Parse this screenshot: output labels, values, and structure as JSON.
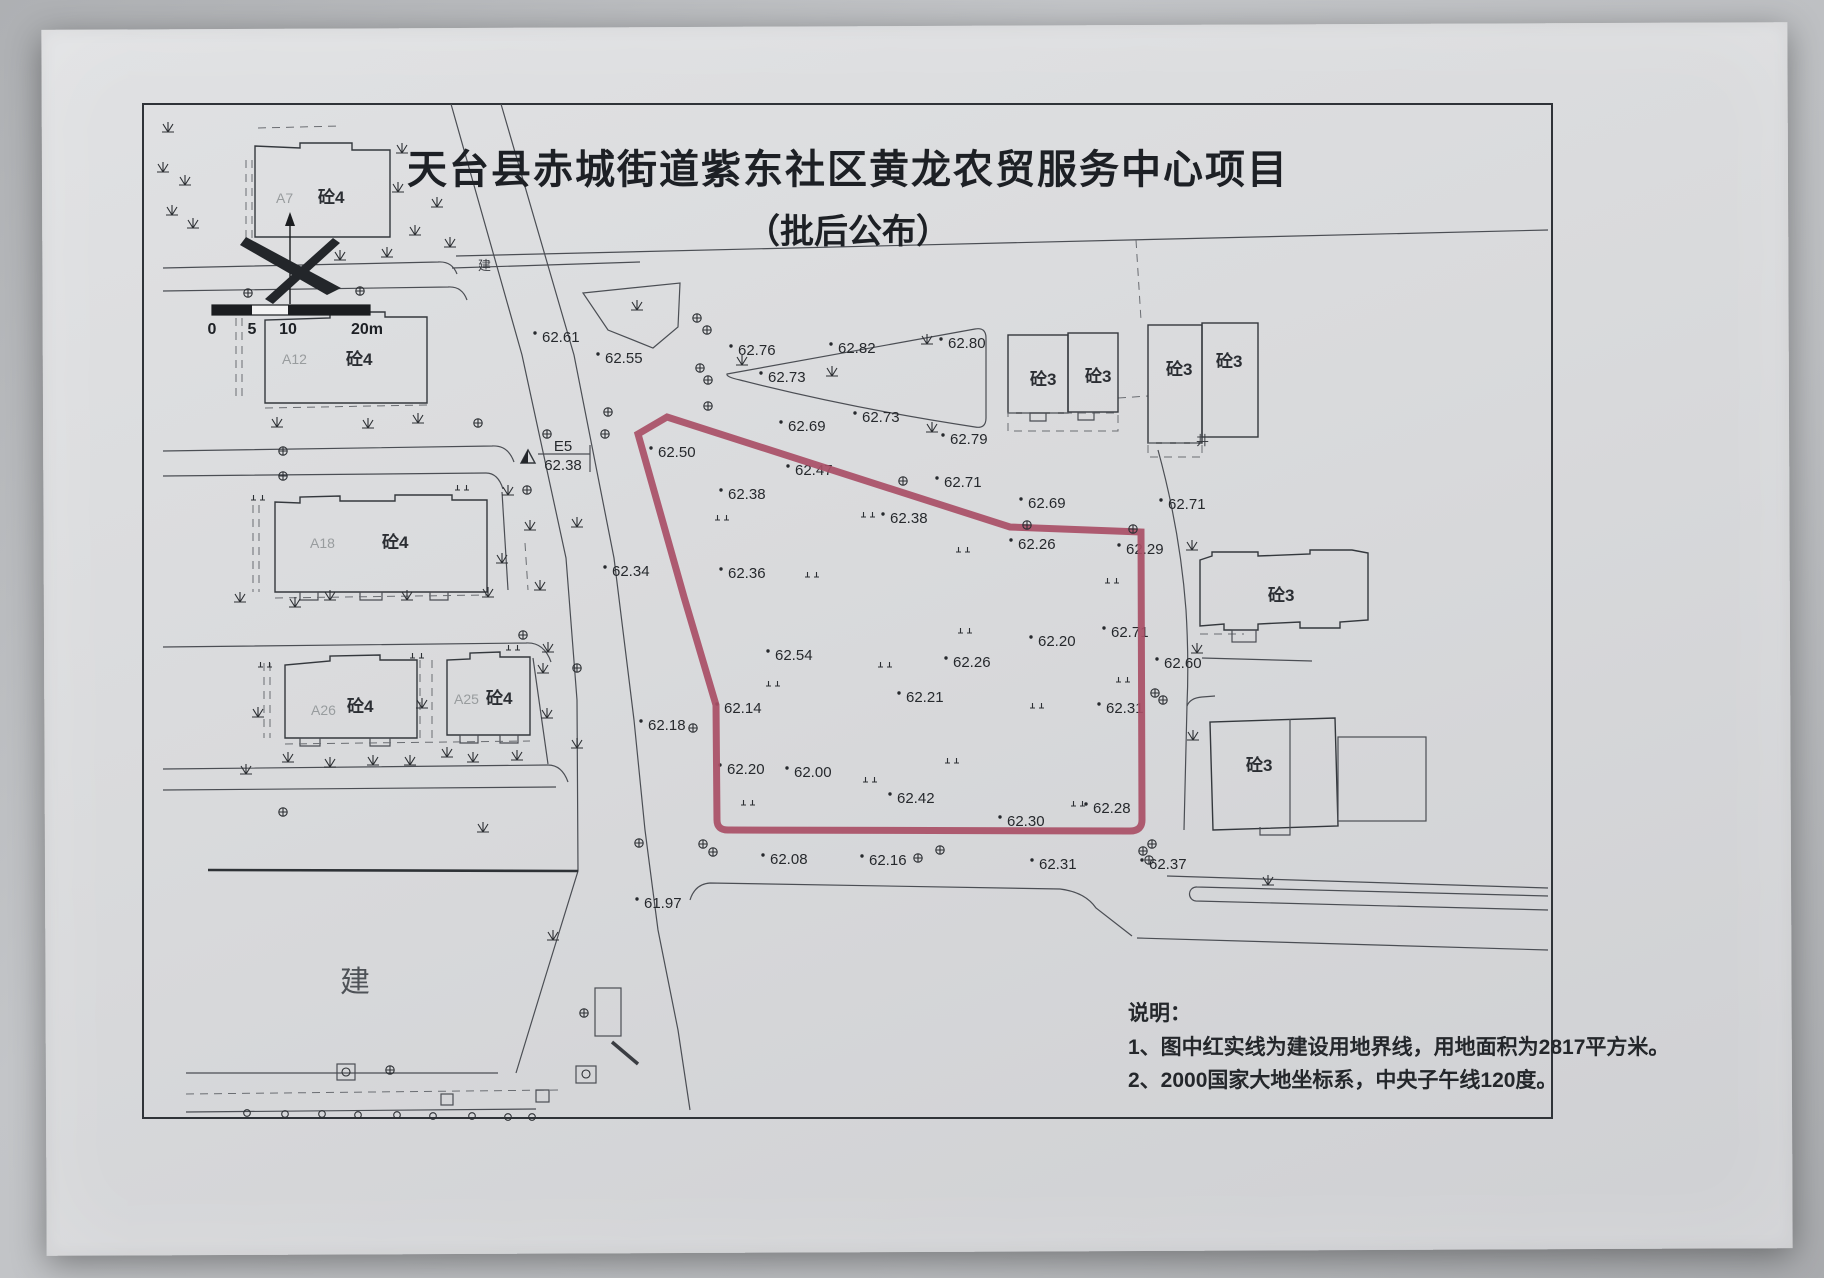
{
  "header": {
    "title": "天台县赤城街道紫东社区黄龙农贸服务中心项目",
    "subtitle": "（批后公布）"
  },
  "notes": {
    "heading": "说明：",
    "items": [
      "1、图中红实线为建设用地界线，用地面积为2817平方米。",
      "2、2000国家大地坐标系，中央子午线120度。"
    ]
  },
  "scale_bar": {
    "ticks": [
      "0",
      "5",
      "10",
      "20m"
    ]
  },
  "datum_point": {
    "label": "E5",
    "elevation": "62.38"
  },
  "map_labels": {
    "concrete4": "砼4",
    "concrete3": "砼3",
    "under_construction": "建",
    "well": "井"
  },
  "building_codes": [
    "A7",
    "A12",
    "A18",
    "A26",
    "A25"
  ],
  "boundary": {
    "color": "#a94f66"
  },
  "spot_elevations": [
    {
      "v": "62.61",
      "x": 542,
      "y": 337
    },
    {
      "v": "62.55",
      "x": 605,
      "y": 358
    },
    {
      "v": "62.76",
      "x": 738,
      "y": 350
    },
    {
      "v": "62.82",
      "x": 838,
      "y": 348
    },
    {
      "v": "62.80",
      "x": 948,
      "y": 343
    },
    {
      "v": "62.73",
      "x": 768,
      "y": 377
    },
    {
      "v": "62.73",
      "x": 862,
      "y": 417
    },
    {
      "v": "62.69",
      "x": 788,
      "y": 426
    },
    {
      "v": "62.79",
      "x": 950,
      "y": 439
    },
    {
      "v": "62.50",
      "x": 658,
      "y": 452
    },
    {
      "v": "62.47",
      "x": 795,
      "y": 470
    },
    {
      "v": "62.71",
      "x": 944,
      "y": 482
    },
    {
      "v": "62.38",
      "x": 728,
      "y": 494
    },
    {
      "v": "62.38",
      "x": 890,
      "y": 518
    },
    {
      "v": "62.69",
      "x": 1028,
      "y": 503
    },
    {
      "v": "62.71",
      "x": 1168,
      "y": 504
    },
    {
      "v": "62.26",
      "x": 1018,
      "y": 544
    },
    {
      "v": "62.29",
      "x": 1126,
      "y": 549
    },
    {
      "v": "62.34",
      "x": 612,
      "y": 571
    },
    {
      "v": "62.36",
      "x": 728,
      "y": 573
    },
    {
      "v": "62.54",
      "x": 775,
      "y": 655
    },
    {
      "v": "62.26",
      "x": 953,
      "y": 662
    },
    {
      "v": "62.20",
      "x": 1038,
      "y": 641
    },
    {
      "v": "62.71",
      "x": 1111,
      "y": 632
    },
    {
      "v": "62.60",
      "x": 1164,
      "y": 663
    },
    {
      "v": "62.21",
      "x": 906,
      "y": 697
    },
    {
      "v": "62.31",
      "x": 1106,
      "y": 708
    },
    {
      "v": "62.14",
      "x": 724,
      "y": 708
    },
    {
      "v": "62.18",
      "x": 648,
      "y": 725
    },
    {
      "v": "62.20",
      "x": 727,
      "y": 769
    },
    {
      "v": "62.00",
      "x": 794,
      "y": 772
    },
    {
      "v": "62.42",
      "x": 897,
      "y": 798
    },
    {
      "v": "62.28",
      "x": 1093,
      "y": 808
    },
    {
      "v": "62.30",
      "x": 1007,
      "y": 821
    },
    {
      "v": "62.08",
      "x": 770,
      "y": 859
    },
    {
      "v": "62.16",
      "x": 869,
      "y": 860
    },
    {
      "v": "62.31",
      "x": 1039,
      "y": 864
    },
    {
      "v": "62.37",
      "x": 1149,
      "y": 864
    },
    {
      "v": "61.97",
      "x": 644,
      "y": 903
    }
  ]
}
